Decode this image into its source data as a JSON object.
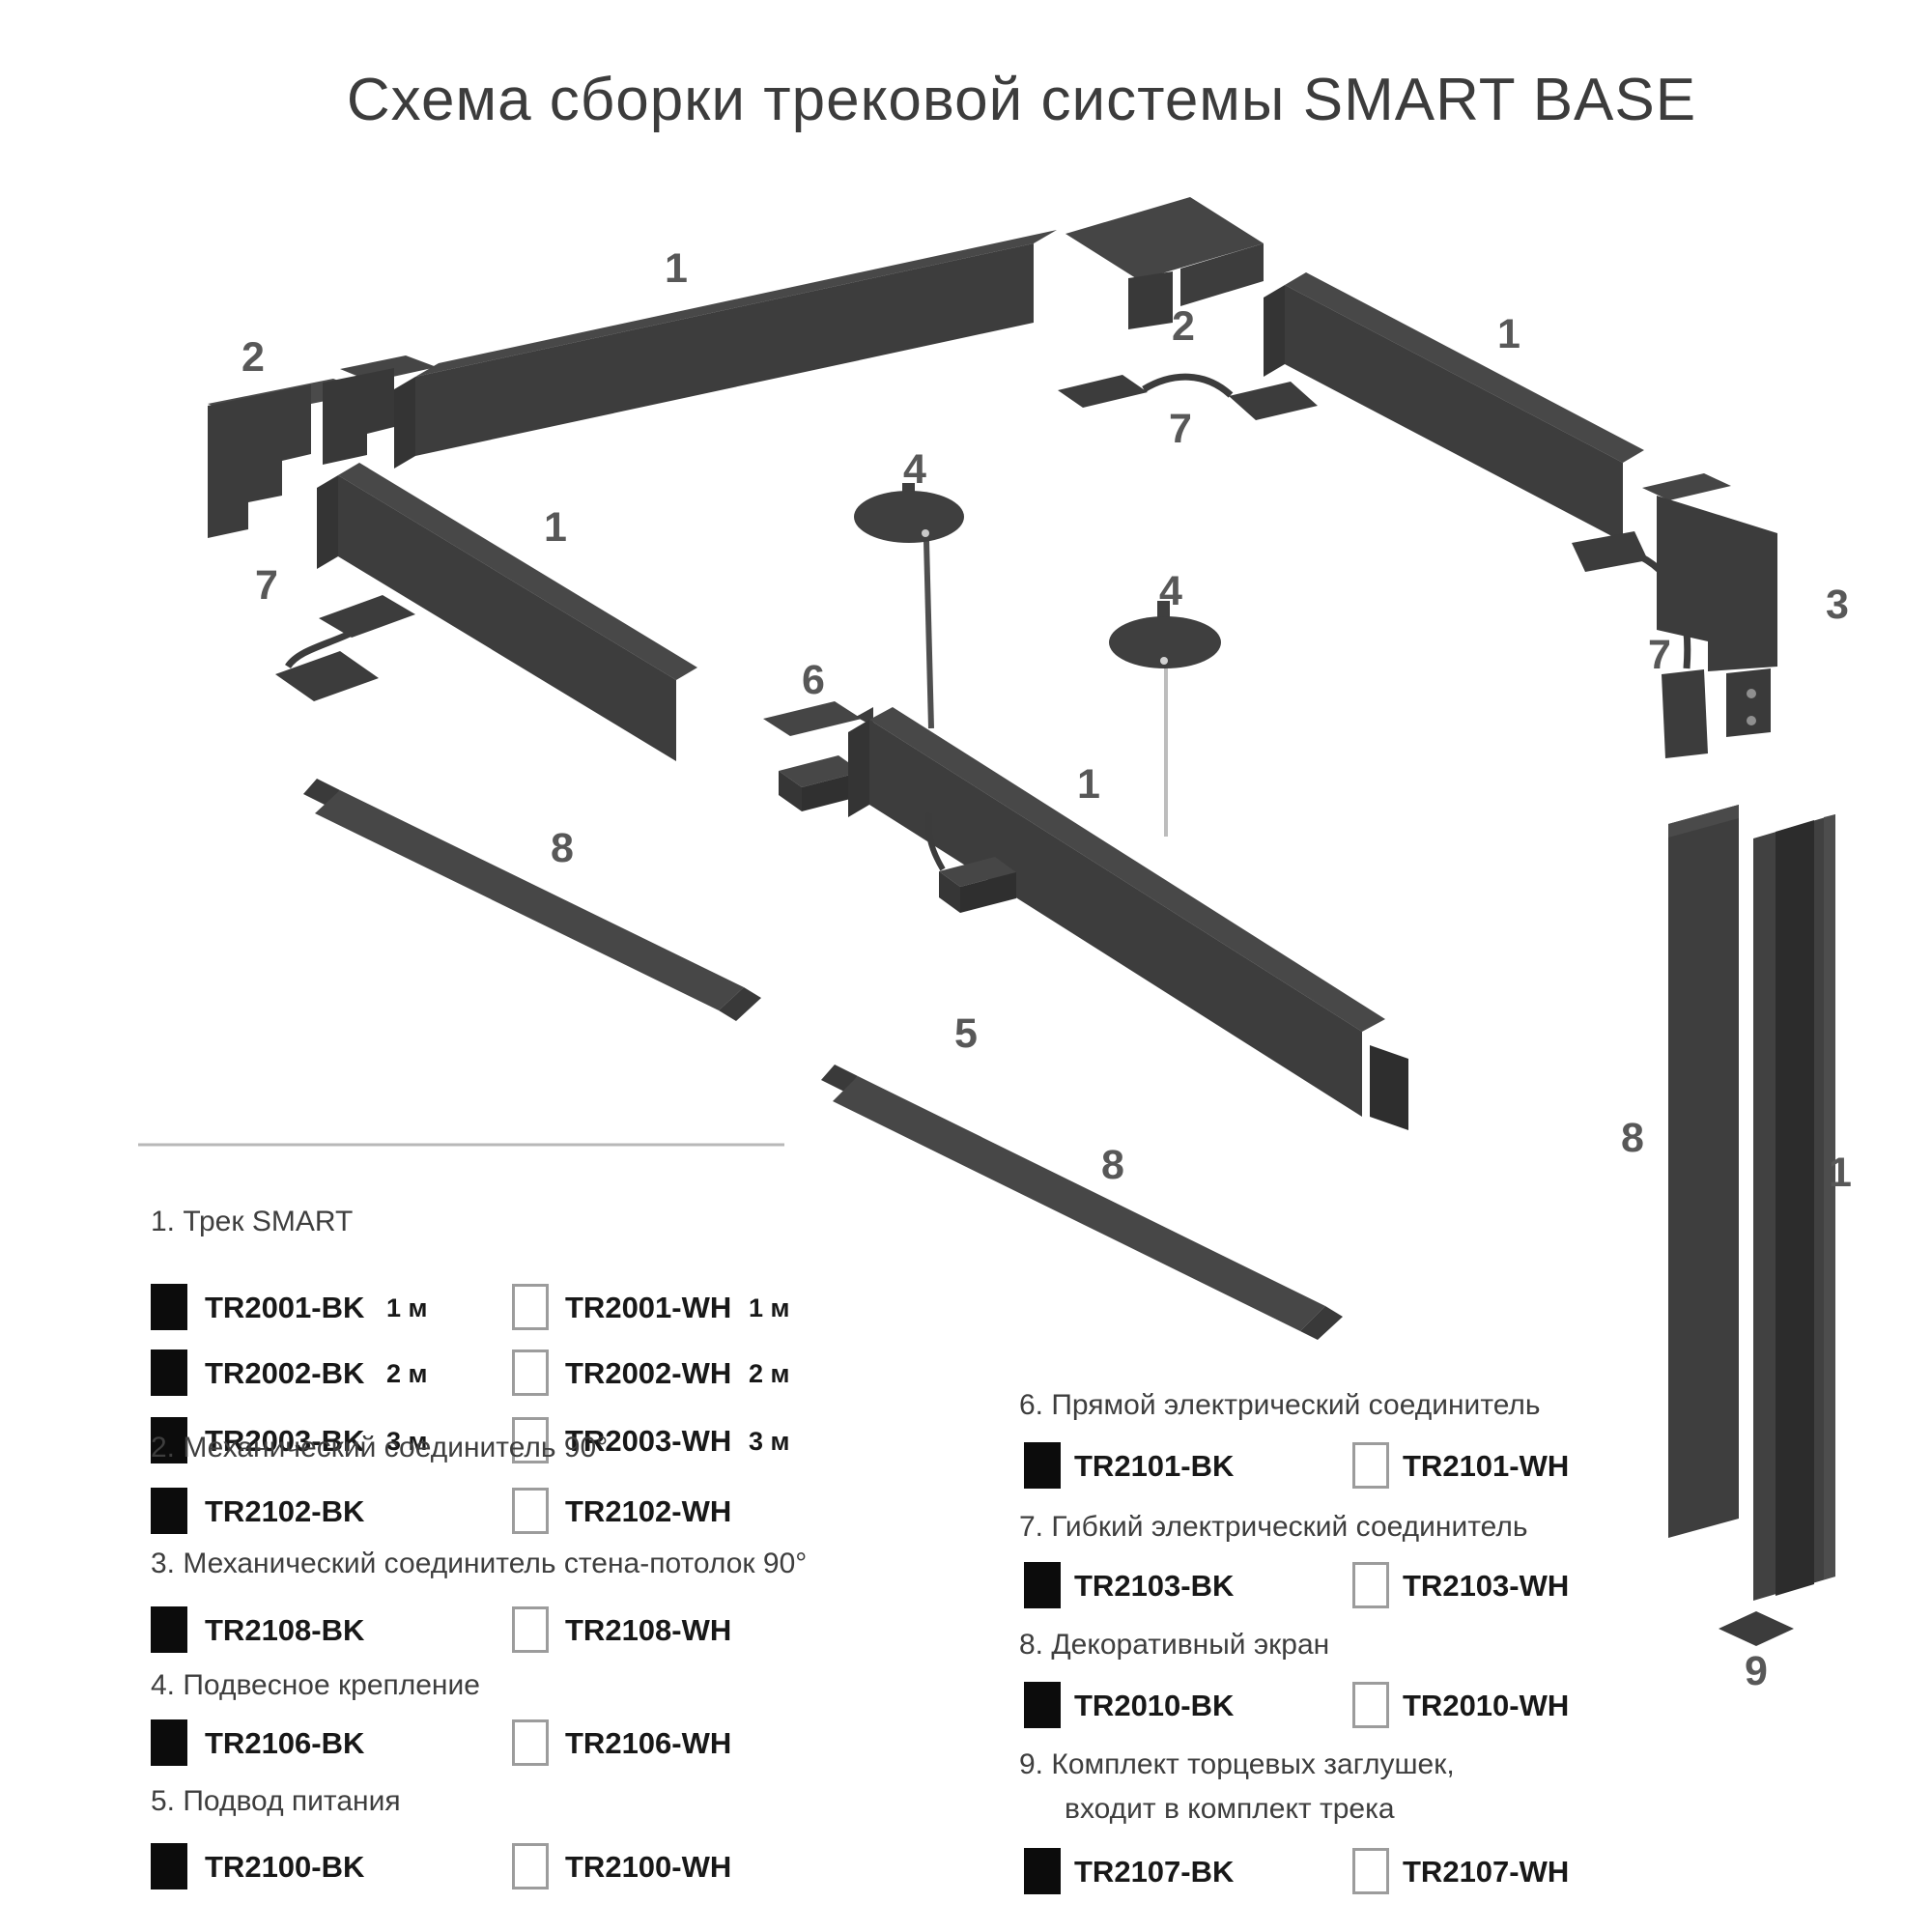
{
  "title": "Схема сборки трековой системы SMART BASE",
  "colors": {
    "part_fill": "#3d3d3d",
    "part_top": "#484848",
    "label": "#585858",
    "code_text": "#181818",
    "swatch_black": "#0c0c0c",
    "swatch_white_border": "#9c9c9c"
  },
  "diagram": {
    "labels": [
      "1",
      "2",
      "1",
      "7",
      "8",
      "2",
      "7",
      "1",
      "4",
      "4",
      "6",
      "1",
      "5",
      "8",
      "3",
      "7",
      "8",
      "1",
      "9"
    ]
  },
  "legend": {
    "sections": [
      {
        "header": "1. Трек SMART",
        "rows": [
          {
            "bk": "TR2001-BK",
            "bk_len": "1 м",
            "wh": "TR2001-WH",
            "wh_len": "1 м"
          },
          {
            "bk": "TR2002-BK",
            "bk_len": "2 м",
            "wh": "TR2002-WH",
            "wh_len": "2 м"
          },
          {
            "bk": "TR2003-BK",
            "bk_len": "3 м",
            "wh": "TR2003-WH",
            "wh_len": "3 м"
          }
        ]
      },
      {
        "header": "2. Механический соединитель 90°",
        "rows": [
          {
            "bk": "TR2102-BK",
            "wh": "TR2102-WH"
          }
        ]
      },
      {
        "header": "3. Механический соединитель стена-потолок 90°",
        "rows": [
          {
            "bk": "TR2108-BK",
            "wh": "TR2108-WH"
          }
        ]
      },
      {
        "header": "4. Подвесное крепление",
        "rows": [
          {
            "bk": "TR2106-BK",
            "wh": "TR2106-WH"
          }
        ]
      },
      {
        "header": "5. Подвод питания",
        "rows": [
          {
            "bk": "TR2100-BK",
            "wh": "TR2100-WH"
          }
        ]
      },
      {
        "header": "6. Прямой электрический соединитель",
        "rows": [
          {
            "bk": "TR2101-BK",
            "wh": "TR2101-WH"
          }
        ]
      },
      {
        "header": "7. Гибкий электрический соединитель",
        "rows": [
          {
            "bk": "TR2103-BK",
            "wh": "TR2103-WH"
          }
        ]
      },
      {
        "header": "8. Декоративный экран",
        "rows": [
          {
            "bk": "TR2010-BK",
            "wh": "TR2010-WH"
          }
        ]
      },
      {
        "header": "9. Комплект торцевых заглушек,",
        "header2": "входит в комплект трека",
        "rows": [
          {
            "bk": "TR2107-BK",
            "wh": "TR2107-WH"
          }
        ]
      }
    ]
  }
}
